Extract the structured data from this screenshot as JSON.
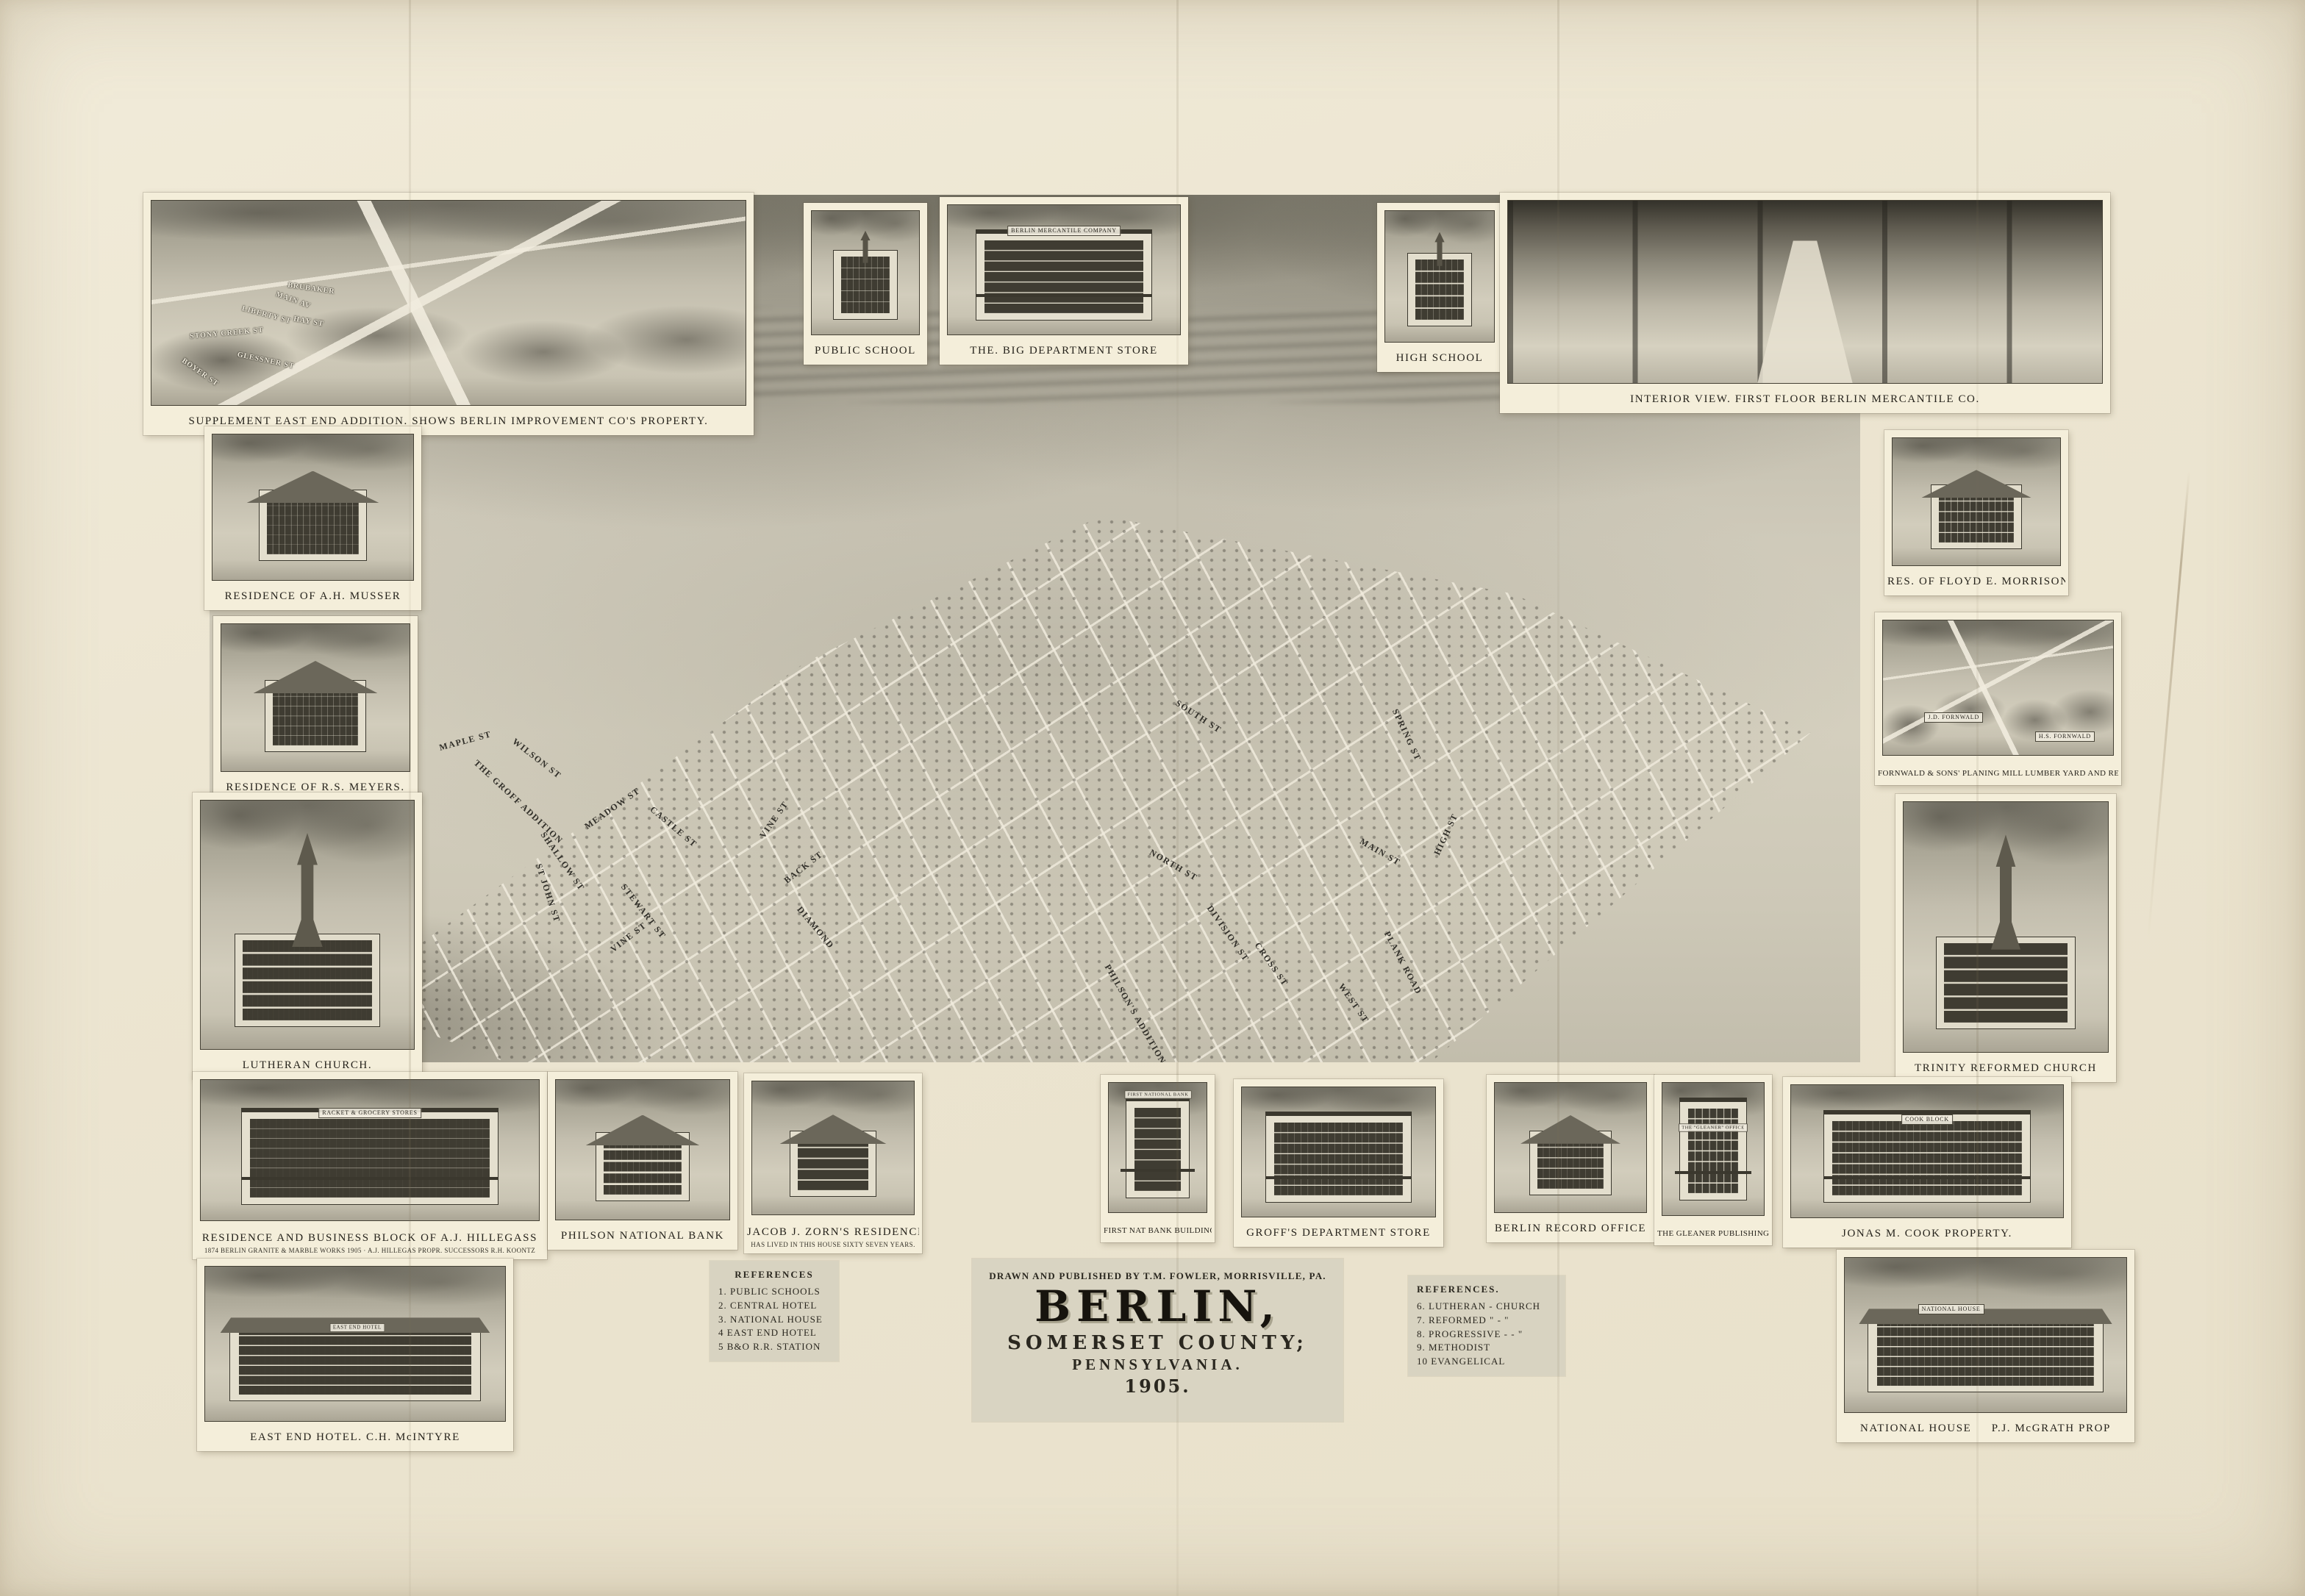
{
  "palette": {
    "paper": "#ece5d1",
    "mat": "#f4eeda",
    "ink": "#2a271f",
    "wash_dark": "#8d8a7d",
    "wash_light": "#d6d1c0"
  },
  "title_block": {
    "credit": "DRAWN AND PUBLISHED BY T.M. FOWLER, MORRISVILLE, PA.",
    "title": "BERLIN,",
    "subtitle1": "SOMERSET COUNTY;",
    "subtitle2": "PENNSYLVANIA.",
    "year": "1905."
  },
  "references_left": {
    "heading": "REFERENCES",
    "items": [
      "1. PUBLIC SCHOOLS",
      "2. CENTRAL HOTEL",
      "3. NATIONAL HOUSE",
      "4 EAST END HOTEL",
      "5 B&O R.R. STATION"
    ]
  },
  "references_right": {
    "heading": "REFERENCES.",
    "items": [
      "6. LUTHERAN - CHURCH",
      "7. REFORMED \" - \"",
      "8. PROGRESSIVE - - \"",
      "9. METHODIST",
      "10 EVANGELICAL"
    ]
  },
  "vignettes": [
    {
      "caption": "SUPPLEMENT EAST END ADDITION. SHOWS BERLIN IMPROVEMENT CO'S PROPERTY."
    },
    {
      "caption": "PUBLIC SCHOOL"
    },
    {
      "caption": "THE. BIG DEPARTMENT STORE",
      "sign": "BERLIN MERCANTILE COMPANY"
    },
    {
      "caption": "HIGH SCHOOL"
    },
    {
      "caption": "INTERIOR VIEW. FIRST FLOOR BERLIN MERCANTILE CO."
    },
    {
      "caption": "RESIDENCE OF A.H. MUSSER"
    },
    {
      "caption": "RESIDENCE OF R.S. MEYERS."
    },
    {
      "caption": "LUTHERAN CHURCH."
    },
    {
      "caption": "RES. OF FLOYD E. MORRISON."
    },
    {
      "caption": "FORNWALD & SONS' PLANING MILL LUMBER YARD AND RESIDENCES",
      "sign": "J.D. FORNWALD",
      "sign2": "H.S. FORNWALD"
    },
    {
      "caption": "TRINITY REFORMED CHURCH",
      "sign": ""
    },
    {
      "caption": "RESIDENCE AND BUSINESS BLOCK OF A.J. HILLEGASS",
      "note": "1874 BERLIN GRANITE & MARBLE WORKS 1905 · A.J. HILLEGAS PROPR. SUCCESSORS R.H. KOONTZ",
      "sign": "RACKET & GROCERY STORES"
    },
    {
      "caption": "PHILSON NATIONAL BANK"
    },
    {
      "caption": "JACOB J. ZORN'S RESIDENCE",
      "note": "HAS LIVED IN THIS HOUSE SIXTY SEVEN YEARS."
    },
    {
      "caption": "FIRST NAT BANK BUILDING",
      "sign": "FIRST NATIONAL BANK"
    },
    {
      "caption": "GROFF'S DEPARTMENT STORE"
    },
    {
      "caption": "BERLIN RECORD OFFICE"
    },
    {
      "caption": "THE GLEANER PUBLISHING CO.",
      "sign": "THE \"GLEANER\" OFFICE"
    },
    {
      "caption": "JONAS M. COOK PROPERTY.",
      "sign": "COOK BLOCK"
    },
    {
      "caption": "EAST END HOTEL. C.H. McINTYRE",
      "sign": "EAST END HOTEL"
    },
    {
      "caption": "NATIONAL HOUSE   P.J. McGRATH PROP",
      "sign": "NATIONAL HOUSE"
    }
  ],
  "map": {
    "streets": [
      {
        "name": "MAPLE ST"
      },
      {
        "name": "WILSON ST"
      },
      {
        "name": "THE GROFF ADDITION"
      },
      {
        "name": "MEADOW ST"
      },
      {
        "name": "CASTLE ST"
      },
      {
        "name": "SHALLOW ST"
      },
      {
        "name": "ST JOHN ST"
      },
      {
        "name": "STEWART ST"
      },
      {
        "name": "VINE ST"
      },
      {
        "name": "VINE ST"
      },
      {
        "name": "BACK ST"
      },
      {
        "name": "DIAMOND"
      },
      {
        "name": "SOUTH ST"
      },
      {
        "name": "SPRING ST"
      },
      {
        "name": "NORTH ST"
      },
      {
        "name": "MAIN ST"
      },
      {
        "name": "HIGH ST"
      },
      {
        "name": "DIVISION ST"
      },
      {
        "name": "CROSS ST"
      },
      {
        "name": "WEST ST"
      },
      {
        "name": "PLANK ROAD"
      },
      {
        "name": "PHILSON'S ADDITION"
      }
    ]
  },
  "supplement": {
    "streets": [
      {
        "name": "STONY CREEK ST"
      },
      {
        "name": "LIBERTY ST"
      },
      {
        "name": "HAY ST"
      },
      {
        "name": "GLESSNER ST"
      },
      {
        "name": "BOYER ST"
      },
      {
        "name": "MAIN AV"
      },
      {
        "name": "BRUBAKER"
      }
    ]
  }
}
